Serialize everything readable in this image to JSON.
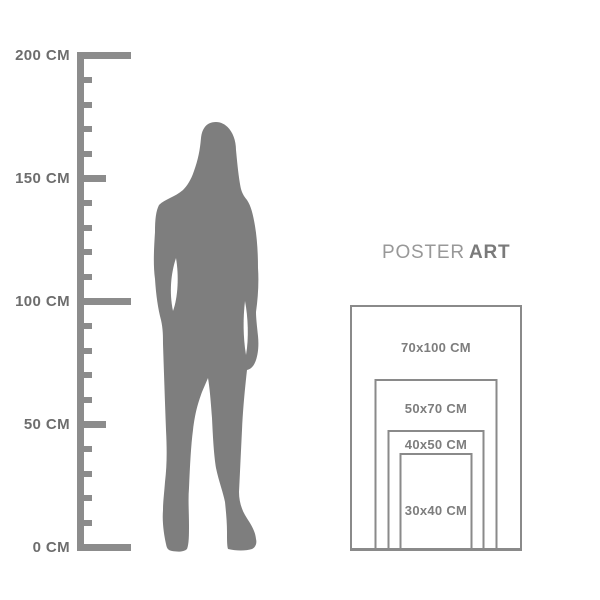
{
  "title": {
    "poster": "POSTER",
    "art": "ART"
  },
  "ruler": {
    "unit": "CM",
    "max_cm": 200,
    "minor_step_cm": 10,
    "labeled_marks": [
      {
        "cm": 200,
        "label": "200 CM"
      },
      {
        "cm": 150,
        "label": "150 CM"
      },
      {
        "cm": 100,
        "label": "100 CM"
      },
      {
        "cm": 50,
        "label": "50 CM"
      },
      {
        "cm": 0,
        "label": "0 CM"
      }
    ]
  },
  "silhouette": {
    "name": "standing-woman",
    "color": "#7e7e7e"
  },
  "poster_sizes": [
    {
      "label": "70x100 CM",
      "width_cm": 70,
      "height_cm": 100
    },
    {
      "label": "50x70 CM",
      "width_cm": 50,
      "height_cm": 70
    },
    {
      "label": "40x50 CM",
      "width_cm": 40,
      "height_cm": 50
    },
    {
      "label": "30x40 CM",
      "width_cm": 30,
      "height_cm": 40
    }
  ],
  "colors": {
    "ruler": "#8c8c8c",
    "ruler_label": "#6d6d6d",
    "frame_border": "#8a8a8a",
    "frame_label": "#7d7d7d",
    "title_poster": "#989898",
    "title_art": "#7a7a7a",
    "silhouette": "#7e7e7e"
  }
}
